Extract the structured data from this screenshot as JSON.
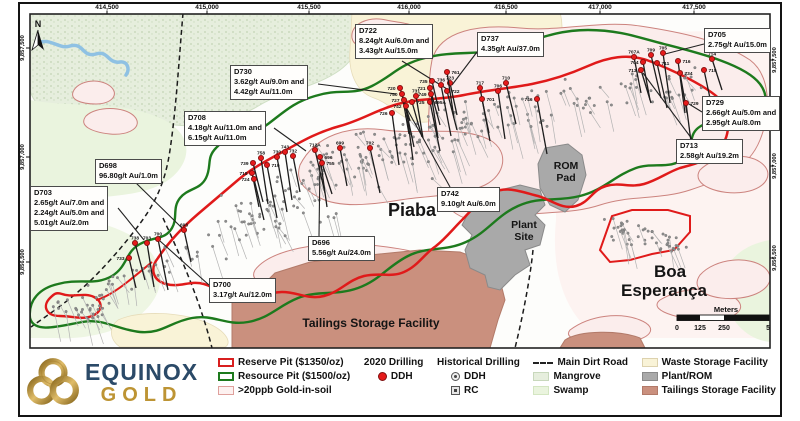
{
  "colors": {
    "reserve_pit_red": "#d81f1f",
    "resource_pit_green": "#1d7a1d",
    "soil_anomaly_pink": "#dfa09c",
    "ddh_2020_red": "#e51b1b",
    "historical_gray": "#8d8d8d",
    "waste_cream": "#f9f3d7",
    "plant_rom_gray": "#a9a9a9",
    "tailings_salmon": "#ca907e",
    "mangrove_green": "#e6eedd",
    "swamp_green": "#eaf4de",
    "river_blue": "#8fc1e3",
    "logo_navy": "#2b4a68",
    "logo_gold": "#bd9434"
  },
  "logo": {
    "top": "EQUINOX",
    "bottom": "GOLD"
  },
  "north_label": "N",
  "map": {
    "axis_top": [
      {
        "label": "414,500",
        "x": 107
      },
      {
        "label": "415,000",
        "x": 207
      },
      {
        "label": "415,500",
        "x": 309
      },
      {
        "label": "416,000",
        "x": 409
      },
      {
        "label": "416,500",
        "x": 506
      },
      {
        "label": "417,000",
        "x": 600
      },
      {
        "label": "417,500",
        "x": 694
      }
    ],
    "axis_left": [
      {
        "label": "9,857,500",
        "y": 48
      },
      {
        "label": "9,857,000",
        "y": 157
      },
      {
        "label": "9,856,500",
        "y": 262
      }
    ],
    "axis_right": [
      {
        "label": "9,857,500",
        "y": 60
      },
      {
        "label": "9,857,000",
        "y": 166
      },
      {
        "label": "9,856,500",
        "y": 258
      }
    ],
    "place_labels": [
      {
        "text": "Piaba",
        "x": 412,
        "y": 216,
        "size": 18
      },
      {
        "text": "Boa",
        "x": 670,
        "y": 277,
        "size": 17
      },
      {
        "text": "Esperança",
        "x": 664,
        "y": 296,
        "size": 17
      },
      {
        "text": "ROM",
        "x": 566,
        "y": 169,
        "size": 10.5
      },
      {
        "text": "Pad",
        "x": 566,
        "y": 181,
        "size": 10.5
      },
      {
        "text": "Plant",
        "x": 524,
        "y": 228,
        "size": 10.5
      },
      {
        "text": "Site",
        "x": 524,
        "y": 240,
        "size": 10.5
      },
      {
        "text": "Tailings Storage Facility",
        "x": 371,
        "y": 327,
        "size": 12
      }
    ],
    "scalebar": {
      "title": "Meters",
      "ticks": [
        {
          "label": "0",
          "x": 677
        },
        {
          "label": "125",
          "x": 700
        },
        {
          "label": "250",
          "x": 724
        },
        {
          "label": "500",
          "x": 772
        }
      ]
    },
    "drill_2020": [
      {
        "id": "733",
        "x": 129,
        "y": 258,
        "la": "l"
      },
      {
        "id": "738",
        "x": 135,
        "y": 243,
        "la": "t"
      },
      {
        "id": "703",
        "x": 147,
        "y": 243,
        "la": "t"
      },
      {
        "id": "700",
        "x": 158,
        "y": 239,
        "la": "t"
      },
      {
        "id": "698",
        "x": 184,
        "y": 230,
        "la": "t"
      },
      {
        "id": "739",
        "x": 253,
        "y": 163,
        "la": "l"
      },
      {
        "id": "758",
        "x": 261,
        "y": 158,
        "la": "t"
      },
      {
        "id": "719",
        "x": 267,
        "y": 165,
        "la": "r"
      },
      {
        "id": "718",
        "x": 252,
        "y": 173,
        "la": "l"
      },
      {
        "id": "724",
        "x": 254,
        "y": 179,
        "la": "l"
      },
      {
        "id": "743",
        "x": 285,
        "y": 152,
        "la": "t"
      },
      {
        "id": "730",
        "x": 277,
        "y": 157,
        "la": "t"
      },
      {
        "id": "732",
        "x": 293,
        "y": 156,
        "la": "t"
      },
      {
        "id": "712A",
        "x": 315,
        "y": 150,
        "la": "t"
      },
      {
        "id": "696",
        "x": 320,
        "y": 157,
        "la": "r"
      },
      {
        "id": "755",
        "x": 322,
        "y": 163,
        "la": "r"
      },
      {
        "id": "699",
        "x": 340,
        "y": 148,
        "la": "t"
      },
      {
        "id": "702",
        "x": 370,
        "y": 148,
        "la": "t"
      },
      {
        "id": "726",
        "x": 392,
        "y": 113,
        "la": "l"
      },
      {
        "id": "720",
        "x": 400,
        "y": 88,
        "la": "l"
      },
      {
        "id": "750",
        "x": 402,
        "y": 94,
        "la": "l"
      },
      {
        "id": "727",
        "x": 404,
        "y": 100,
        "la": "l"
      },
      {
        "id": "742",
        "x": 406,
        "y": 106,
        "la": "l"
      },
      {
        "id": "725",
        "x": 412,
        "y": 102,
        "la": "r"
      },
      {
        "id": "731",
        "x": 416,
        "y": 96,
        "la": "t"
      },
      {
        "id": "695A",
        "x": 430,
        "y": 102,
        "la": "r"
      },
      {
        "id": "735",
        "x": 432,
        "y": 81,
        "la": "l"
      },
      {
        "id": "721",
        "x": 430,
        "y": 88,
        "la": "l"
      },
      {
        "id": "749",
        "x": 431,
        "y": 94,
        "la": "l"
      },
      {
        "id": "736",
        "x": 441,
        "y": 85,
        "la": "t"
      },
      {
        "id": "723",
        "x": 450,
        "y": 83,
        "la": "t"
      },
      {
        "id": "722",
        "x": 447,
        "y": 91,
        "la": "r"
      },
      {
        "id": "761",
        "x": 447,
        "y": 72,
        "la": "r"
      },
      {
        "id": "717",
        "x": 480,
        "y": 88,
        "la": "t"
      },
      {
        "id": "701",
        "x": 482,
        "y": 99,
        "la": "r"
      },
      {
        "id": "710",
        "x": 506,
        "y": 83,
        "la": "t"
      },
      {
        "id": "706",
        "x": 498,
        "y": 91,
        "la": "t"
      },
      {
        "id": "746",
        "x": 537,
        "y": 99,
        "la": "l"
      },
      {
        "id": "707A",
        "x": 634,
        "y": 57,
        "la": "t"
      },
      {
        "id": "709",
        "x": 651,
        "y": 55,
        "la": "t"
      },
      {
        "id": "705",
        "x": 663,
        "y": 53,
        "la": "t"
      },
      {
        "id": "714",
        "x": 712,
        "y": 59,
        "la": "t"
      },
      {
        "id": "704",
        "x": 643,
        "y": 62,
        "la": "l"
      },
      {
        "id": "711",
        "x": 657,
        "y": 63,
        "la": "r"
      },
      {
        "id": "716",
        "x": 678,
        "y": 61,
        "la": "r"
      },
      {
        "id": "713",
        "x": 641,
        "y": 70,
        "la": "l"
      },
      {
        "id": "734",
        "x": 680,
        "y": 73,
        "la": "r"
      },
      {
        "id": "715",
        "x": 704,
        "y": 70,
        "la": "r"
      },
      {
        "id": "729",
        "x": 686,
        "y": 103,
        "la": "r"
      }
    ],
    "annotations": [
      {
        "id": "D722",
        "lines": [
          "8.24g/t Au/6.0m and",
          "3.43g/t Au/15.0m"
        ],
        "x": 355,
        "y": 24,
        "leader": [
          402,
          61,
          447,
          89
        ]
      },
      {
        "id": "D737",
        "lines": [
          "4.35g/t Au/37.0m"
        ],
        "x": 477,
        "y": 32,
        "leader": [
          477,
          52,
          452,
          85
        ]
      },
      {
        "id": "D705",
        "lines": [
          "2.75g/t Au/15.0m"
        ],
        "x": 704,
        "y": 28,
        "leader": [
          704,
          44,
          665,
          54
        ]
      },
      {
        "id": "D730",
        "lines": [
          "3.62g/t Au/9.0m and",
          "4.42g/t Au/11.0m"
        ],
        "x": 230,
        "y": 65,
        "leader": [
          318,
          84,
          396,
          94
        ]
      },
      {
        "id": "D708",
        "lines": [
          "4.18g/t Au/11.0m and",
          "6.15g/t Au/11.0m"
        ],
        "x": 184,
        "y": 111,
        "leader": [
          274,
          128,
          306,
          151
        ]
      },
      {
        "id": "D698",
        "lines": [
          "96.80g/t Au/1.0m"
        ],
        "x": 95,
        "y": 159,
        "leader": [
          135,
          182,
          182,
          228
        ]
      },
      {
        "id": "D703",
        "lines": [
          "2.65g/t Au/7.0m and",
          "2.24g/t Au/5.0m and",
          "5.01g/t Au/2.0m"
        ],
        "x": 30,
        "y": 186,
        "leader": [
          118,
          208,
          144,
          240
        ]
      },
      {
        "id": "D700",
        "lines": [
          "3.17g/t Au/12.0m"
        ],
        "x": 209,
        "y": 278,
        "leader": [
          209,
          285,
          160,
          241
        ]
      },
      {
        "id": "D696",
        "lines": [
          "5.56g/t Au/24.0m"
        ],
        "x": 308,
        "y": 236,
        "leader": [
          319,
          236,
          320,
          161
        ]
      },
      {
        "id": "D742",
        "lines": [
          "9.10g/t Au/6.0m"
        ],
        "x": 437,
        "y": 187,
        "leader": [
          450,
          187,
          407,
          109
        ]
      },
      {
        "id": "D713",
        "lines": [
          "2.58g/t Au/19.2m"
        ],
        "x": 676,
        "y": 139,
        "leader": [
          692,
          139,
          643,
          73
        ]
      },
      {
        "id": "D729",
        "lines": [
          "2.66g/t Au/5.0m and",
          "2.95g/t Au/8.0m"
        ],
        "x": 702,
        "y": 96,
        "leader": [
          702,
          112,
          689,
          104
        ]
      }
    ]
  },
  "legend": {
    "columns": [
      {
        "items": [
          {
            "sw": "reserve",
            "label": "Reserve Pit ($1350/oz)"
          },
          {
            "sw": "resource",
            "label": "Resource Pit ($1500/oz)"
          },
          {
            "sw": "soil",
            "label": ">20ppb Gold-in-soil"
          }
        ]
      },
      {
        "header": "2020 Drilling",
        "items": [
          {
            "sw": "ddh2020",
            "label": "DDH"
          }
        ]
      },
      {
        "header": "Historical Drilling",
        "items": [
          {
            "sw": "histddh",
            "label": "DDH"
          },
          {
            "sw": "rc",
            "label": "RC"
          }
        ]
      },
      {
        "items": [
          {
            "sw": "road",
            "label": "Main Dirt Road"
          },
          {
            "sw": "mangrove",
            "label": "Mangrove"
          },
          {
            "sw": "swamp",
            "label": "Swamp"
          }
        ]
      },
      {
        "items": [
          {
            "sw": "waste",
            "label": "Waste Storage Facility"
          },
          {
            "sw": "plant",
            "label": "Plant/ROM"
          },
          {
            "sw": "tailings",
            "label": "Tailings Storage Facility"
          }
        ]
      }
    ]
  }
}
